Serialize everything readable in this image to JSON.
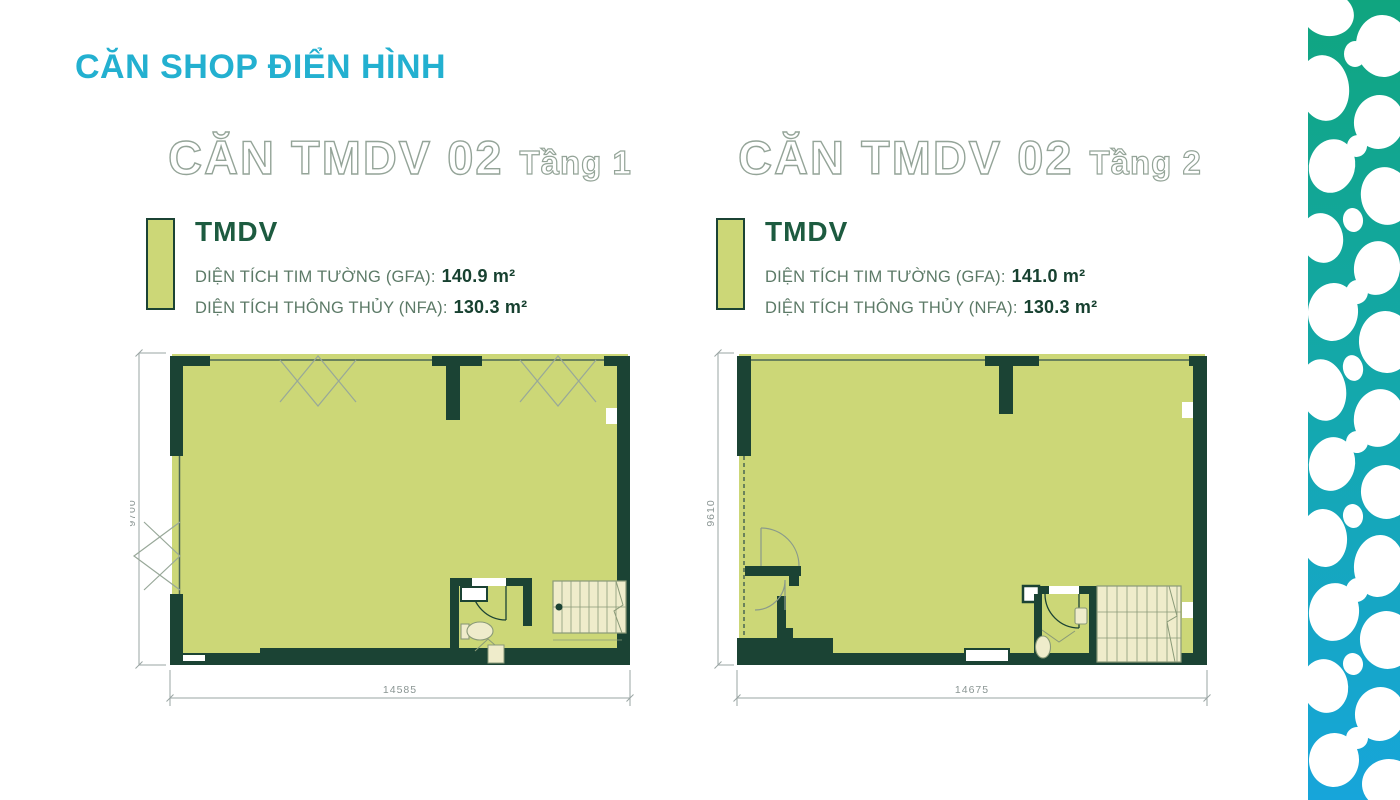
{
  "page_title": "CĂN SHOP ĐIỂN HÌNH",
  "units": [
    {
      "name": "CĂN TMDV 02",
      "floor": "Tầng 1",
      "legend_label": "TMDV",
      "gfa_label": "DIỆN TÍCH TIM TƯỜNG (GFA):",
      "gfa_value": "140.9 m²",
      "nfa_label": "DIỆN TÍCH THÔNG THỦY (NFA):",
      "nfa_value": "130.3 m²",
      "dim_width": "14585",
      "dim_height": "9700"
    },
    {
      "name": "CĂN TMDV 02",
      "floor": "Tầng 2",
      "legend_label": "TMDV",
      "gfa_label": "DIỆN TÍCH TIM TƯỜNG (GFA):",
      "gfa_value": "141.0 m²",
      "nfa_label": "DIỆN TÍCH THÔNG THỦY (NFA):",
      "nfa_value": "130.3 m²",
      "dim_width": "14675",
      "dim_height": "9610"
    }
  ],
  "colors": {
    "title_cyan": "#23b0d0",
    "heading_outline": "#94a498",
    "legend_green": "#1d5b40",
    "plan_fill": "#ccd777",
    "plan_wall": "#1b4334",
    "fixture_cream": "#efeccb",
    "dim_gray": "#9aa5a3",
    "pebble_top": "#10a57f",
    "pebble_bottom": "#17a5da"
  }
}
